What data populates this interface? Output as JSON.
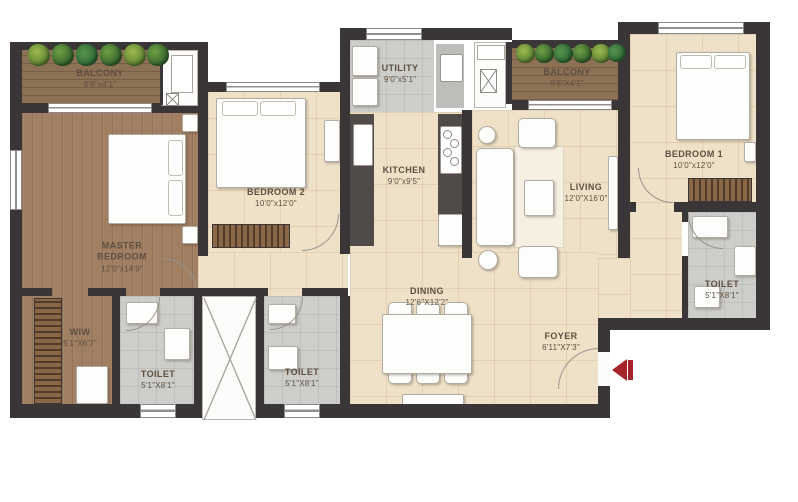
{
  "rooms": {
    "balcony1": {
      "name": "BALCONY",
      "dims": "8'6\"x4'1\""
    },
    "master": {
      "name": "MASTER BEDROOM",
      "dims": "12'0\"x14'9\""
    },
    "wiw": {
      "name": "WIW",
      "dims": "5'1\"X6'7\""
    },
    "toilet_master": {
      "name": "TOILET",
      "dims": "5'1\"X8'1\""
    },
    "toilet_common": {
      "name": "TOILET",
      "dims": "5'1\"X8'1\""
    },
    "bedroom2": {
      "name": "BEDROOM 2",
      "dims": "10'0\"x12'0\""
    },
    "utility": {
      "name": "UTILITY",
      "dims": "9'0\"x5'1\""
    },
    "kitchen": {
      "name": "KITCHEN",
      "dims": "9'0\"x9'5\""
    },
    "balcony2": {
      "name": "BALCONY",
      "dims": "8'6\"X4'1\""
    },
    "living": {
      "name": "LIVING",
      "dims": "12'0\"X16'0\""
    },
    "bedroom1": {
      "name": "BEDROOM 1",
      "dims": "10'0\"x12'0\""
    },
    "toilet1": {
      "name": "TOILET",
      "dims": "5'1\"X8'1\""
    },
    "dining": {
      "name": "DINING",
      "dims": "12'6\"X12'2\""
    },
    "foyer": {
      "name": "FOYER",
      "dims": "6'11\"X7'3\""
    }
  },
  "colors": {
    "wall": "#3a3637",
    "wood_floor": "#a17f63",
    "balcony_wood": "#8d7155",
    "tile_floor": "#efe1c8",
    "wet_floor": "#cdcdc9",
    "label_text": "#5e4f41",
    "entry_arrow": "#a5242a",
    "plant_green": "#4d8a3f"
  }
}
